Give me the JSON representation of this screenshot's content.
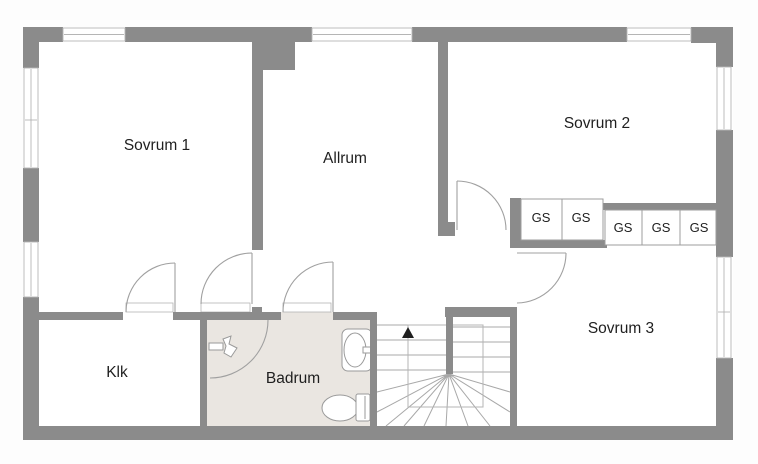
{
  "floorplan": {
    "title": "floor-plan-upper-storey",
    "rooms": [
      {
        "id": "sovrum1",
        "label": "Sovrum 1"
      },
      {
        "id": "allrum",
        "label": "Allrum"
      },
      {
        "id": "sovrum2",
        "label": "Sovrum 2"
      },
      {
        "id": "sovrum3",
        "label": "Sovrum 3"
      },
      {
        "id": "klk",
        "label": "Klk"
      },
      {
        "id": "badrum",
        "label": "Badrum"
      }
    ],
    "closets": {
      "labels": [
        "GS",
        "GS",
        "GS",
        "GS",
        "GS"
      ]
    },
    "stairs": {
      "direction_arrow": "up"
    },
    "colors": {
      "wall": "#8b8b8b",
      "bathroom_floor": "#eae6e1",
      "thin_line": "#a0a0a0",
      "window_line": "#b5b5b5",
      "text": "#1f1f1f",
      "background": "#ffffff"
    }
  }
}
